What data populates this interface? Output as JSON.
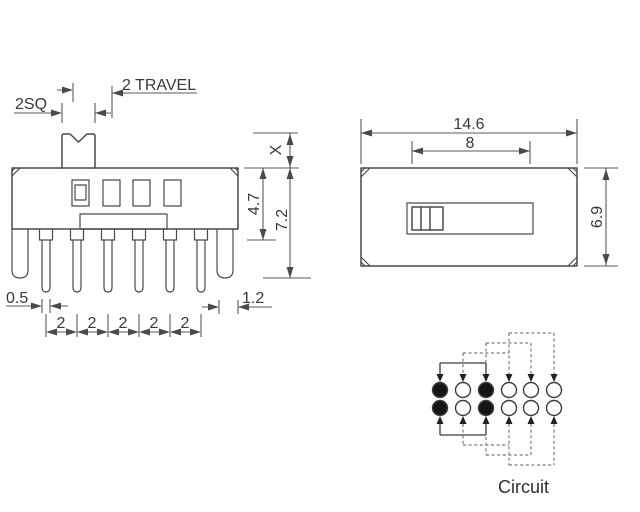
{
  "front_view": {
    "knob_square_label": "2SQ",
    "travel_label": "2 TRAVEL",
    "height_x_label": "X",
    "body_height_label": "4.7",
    "overall_height_label": "7.2",
    "pin_width_label": "0.5",
    "lug_width_label": "1.2",
    "pitch_labels": [
      "2",
      "2",
      "2",
      "2",
      "2"
    ]
  },
  "top_view": {
    "overall_width_label": "14.6",
    "slot_width_label": "8",
    "depth_label": "6.9"
  },
  "circuit": {
    "caption": "Circuit",
    "rows": 2,
    "cols": 6,
    "filled_terminals": [
      [
        1,
        1
      ],
      [
        1,
        3
      ],
      [
        2,
        1
      ],
      [
        2,
        3
      ]
    ],
    "solid_bridge_columns": [
      1,
      3
    ],
    "dashed_bridge_columns": [
      [
        2,
        4
      ],
      [
        3,
        5
      ],
      [
        4,
        6
      ]
    ]
  },
  "colors": {
    "line": "#4a4a4a",
    "dashed_line": "#7a7a7a",
    "text": "#383838",
    "terminal_fill": "#151515",
    "background": "#ffffff"
  }
}
